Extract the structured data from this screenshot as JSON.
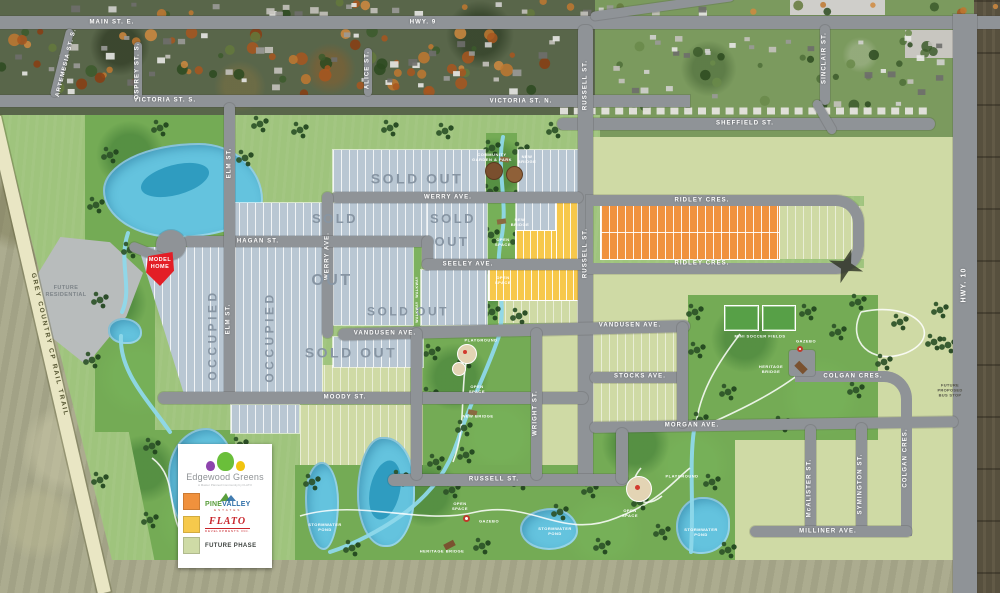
{
  "streets": {
    "main_st_e": "MAIN ST. E.",
    "hwy_9": "HWY. 9",
    "victoria_st_s": "VICTORIA ST. S.",
    "victoria_st_n": "VICTORIA ST. N.",
    "sheffield_st": "SHEFFIELD ST.",
    "russell_st_aerial": "RUSSELL ST.",
    "sinclair_st": "SINCLAIR ST.",
    "artemesia_st_s": "ARTEMESIA ST. S.",
    "osprey_st_s": "OSPREY ST. S.",
    "alice_st": "ALICE ST.",
    "hwy_10": "HWY. 10",
    "werry_ave_h": "WERRY AVE.",
    "werry_ave_v": "WERRY AVE.",
    "hagan_st": "HAGAN ST.",
    "seeley_ave": "SEELEY AVE.",
    "ridley_cres_top": "RIDLEY CRES.",
    "ridley_cres_bottom": "RIDLEY CRES.",
    "elm_st_upper": "ELM ST.",
    "elm_st_lower": "ELM ST.",
    "russell_st_v": "RUSSELL ST.",
    "russell_st_h": "RUSSELL ST.",
    "vandusen_ave_w": "VANDUSEN AVE.",
    "vandusen_ave_e": "VANDUSEN AVE.",
    "stocks_ave": "STOCKS AVE.",
    "moody_st": "MOODY ST.",
    "morgan_ave": "MORGAN AVE.",
    "wright_st": "WRIGHT ST.",
    "mcalister_st": "McALISTER ST.",
    "symington_st": "SYMINGTON ST.",
    "colgan_cres_h": "COLGAN CRES.",
    "colgan_cres_v": "COLGAN CRES.",
    "milliner_ave": "MILLINER AVE."
  },
  "status": {
    "sold_out_top": "SOLD OUT",
    "sold_left": "SOLD",
    "out_left": "OUT",
    "sold_right": "SOLD",
    "out_right": "OUT",
    "sold_out_row": "SOLD OUT",
    "sold_out_big": "SOLD OUT",
    "occupied_1": "OCCUPIED",
    "occupied_2": "OCCUPIED"
  },
  "features": {
    "model_home": "MODEL\nHOME",
    "future_residential": "FUTURE\nRESIDENTIAL",
    "rail_trail": "GREY COUNTRY CP RAIL TRAIL",
    "community_garden": "COMMUNITY\nGARDEN & PARK",
    "new_bridge_top": "NEW\nBRIDGE",
    "new_bridge_mid": "NEW\nBRIDGE",
    "new_bridge_center": "NEW BRIDGE",
    "open_space_1": "OPEN\nSPACE",
    "open_space_2": "OPEN\nSPACE",
    "open_space_3": "OPEN\nSPACE",
    "open_space_4": "OPEN\nSPACE",
    "open_space_5": "OPEN\nSPACE",
    "walkway_1": "WALKWAY",
    "walkway_2": "WALKWAY",
    "playground_1": "PLAYGROUND",
    "playground_2": "PLAYGROUND",
    "gazebo_1": "GAZEBO",
    "gazebo_2": "GAZEBO",
    "stormwater_pond_1": "STORMWATER\nPOND",
    "stormwater_pond_2": "STORMWATER\nPOND",
    "stormwater_pond_3": "STORMWATER\nPOND",
    "heritage_bridge_1": "HERITAGE BRIDGE",
    "heritage_bridge_2": "HERITAGE\nBRIDGE",
    "mini_soccer_fields": "MINI SOCCER FIELDS",
    "future_bus_stop": "FUTURE\nPROPOSED\nBUS STOP"
  },
  "legend": {
    "title": "Edgewood Greens",
    "subtitle": "A Master Planned Community by FLATO",
    "pinevalley": {
      "part1": "PINE",
      "part2": "VALLEY",
      "sub": "ESTATES",
      "swatch": "#F0913D"
    },
    "flato": {
      "name": "FLATO",
      "sub": "DEVELOPMENTS INC.",
      "swatch": "#F6C94C"
    },
    "future": {
      "label": "FUTURE PHASE",
      "swatch": "#CFDBA6"
    }
  },
  "colors": {
    "road": "#8F9397",
    "lot_sold": "#B9C7D3",
    "lot_pinevalley": "#F0923E",
    "lot_flato": "#F7C84B",
    "lot_future": "#CFDAA5",
    "water": "#64C3DE",
    "park": "#74AB55",
    "field": "#9FC47D"
  }
}
